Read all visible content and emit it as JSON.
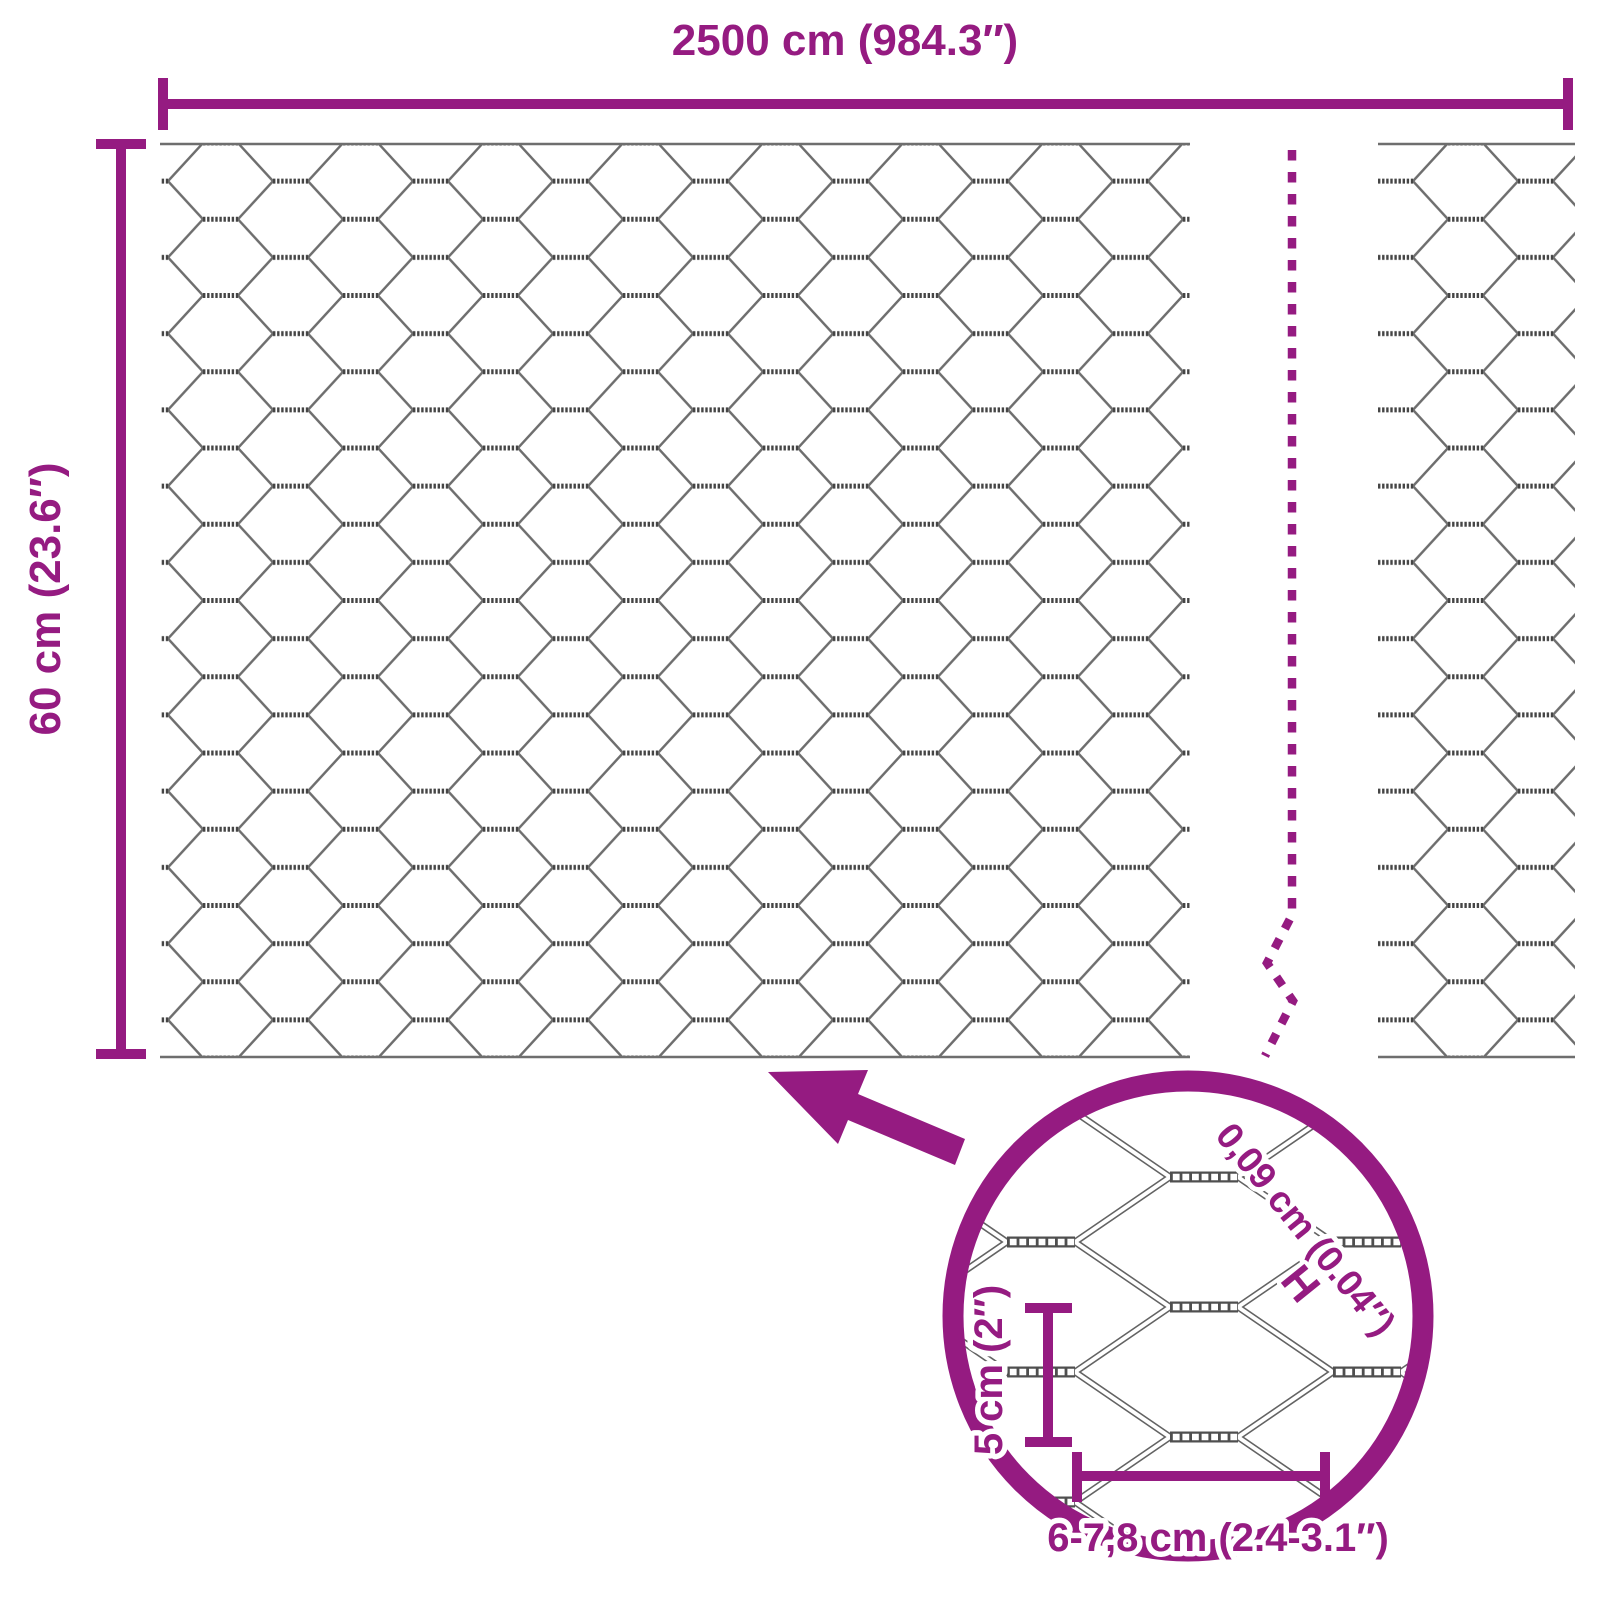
{
  "title": "Hexagonal wire netting dimensions diagram",
  "colors": {
    "accent": "#951b81",
    "wire_gray": "#6e6e6e",
    "twist_gray": "#454545",
    "background": "#ffffff"
  },
  "dimensions": {
    "width_label": "2500 cm (984.3″)",
    "height_label": "60 cm (23.6″)"
  },
  "detail": {
    "wire_thickness_label": "0,09 cm (0.04″)",
    "wire_thickness_marker": "H",
    "cell_height_label": "5 cm (2″)",
    "mesh_size_label": "6-7,8 cm (2.4-3.1″)"
  }
}
